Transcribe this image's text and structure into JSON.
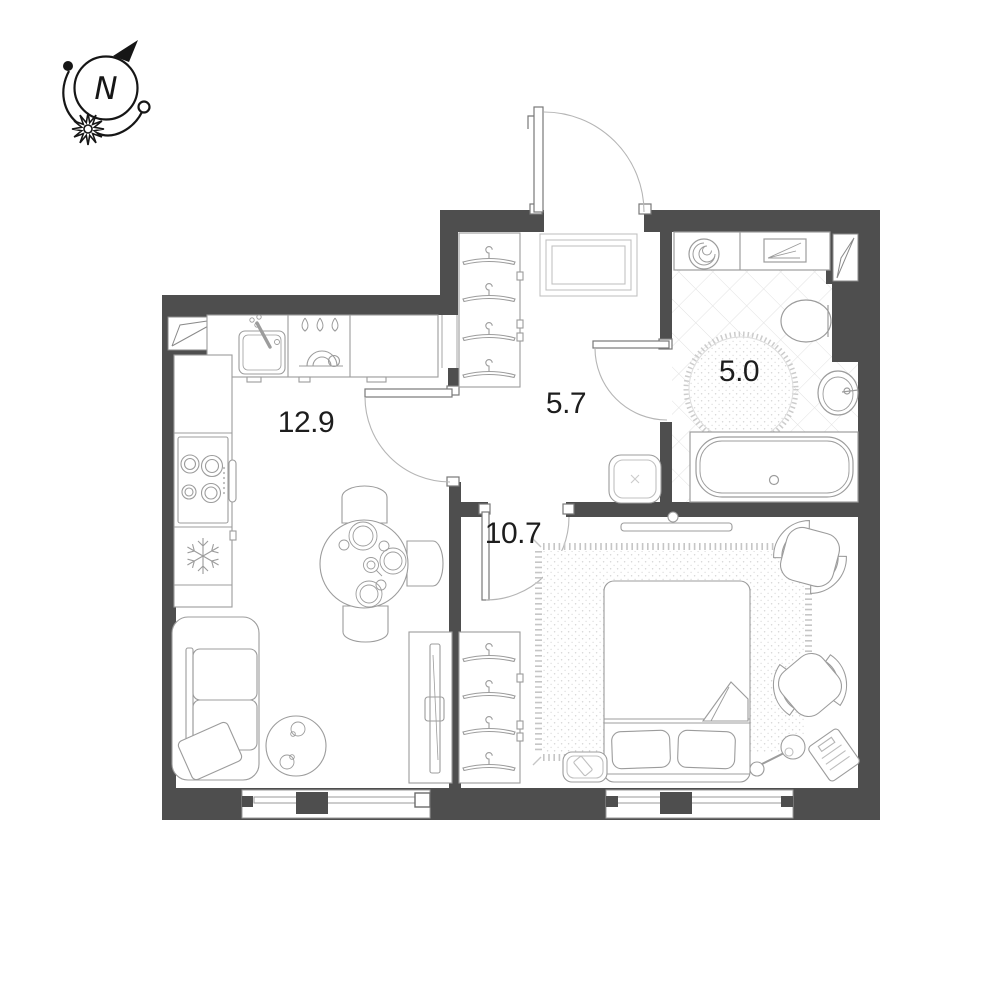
{
  "compass": {
    "north_letter": "N"
  },
  "rooms": {
    "kitchen_living": {
      "area": "12.9"
    },
    "hallway": {
      "area": "5.7"
    },
    "bathroom": {
      "area": "5.0"
    },
    "bedroom": {
      "area": "10.7"
    }
  },
  "colors": {
    "wall": "#4e4e4e",
    "furniture_line": "#9c9c9c",
    "detail_line": "#b9b9b9",
    "door_arc": "#b5b5b5",
    "tile_line": "#e2e2e2",
    "fringe": "#c6c6c6",
    "label_text": "#1d1d1d",
    "compass_ink": "#161616"
  },
  "icons": {
    "compass-icon": "circle with italic N, arrow to north-east, orbit arcs, sunburst",
    "north-arrow-icon": "filled triangle",
    "sunburst-icon": "12-point star",
    "vent-shaft-icon": "wedge in wall niche",
    "kitchen-sink-icon": "square basin with faucet",
    "water-drops-icon": "three drops",
    "dish-rack-icon": "nested arcs with bowl",
    "stove-icon": "four burner rings",
    "snowflake-icon": "fridge snowflake",
    "hanger-icon": "clothes hanger",
    "doormat-icon": "nested rectangles",
    "washing-machine-icon": "spiral drum",
    "towel-shelf-icon": "rectangle with folded towel",
    "toilet-icon": "oval bowl",
    "round-rug-icon": "dotted circle with fringe",
    "wall-sink-icon": "oval basin with tap",
    "bathtub-icon": "rounded tub with drain",
    "pouf-icon": "rounded square with stitch",
    "bed-icon": "double bed with two pillows and folded blanket",
    "tv-icon": "thin screen bar",
    "armchair-icon": "seat with crescent arms",
    "floor-lamp-icon": "shade circle with stem and base",
    "scale-icon": "striped rotated rectangle",
    "sofa-icon": "two-seat sofa with pillow",
    "coffee-table-icon": "round table with two cups",
    "dining-table-icon": "round table, plates, teapot, three chairs",
    "rug-icon": "speckled rectangle with fringe",
    "window-icon": "double glazing line with mullion"
  }
}
